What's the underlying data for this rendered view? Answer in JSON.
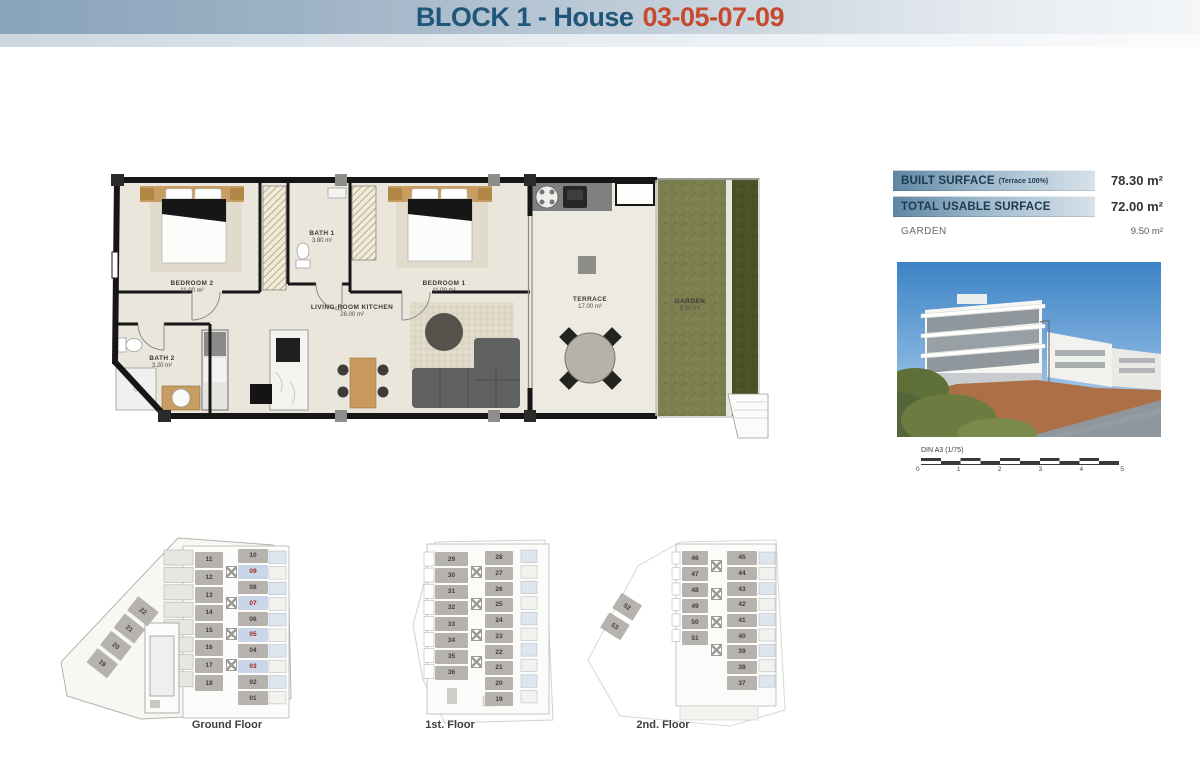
{
  "header": {
    "title_block": "BLOCK 1 - House",
    "title_houses": "03-05-07-09"
  },
  "floor_plan": {
    "rooms": [
      {
        "name": "BEDROOM 2",
        "area": "11.00 m²"
      },
      {
        "name": "BATH 1",
        "area": "3.80 m²"
      },
      {
        "name": "BEDROOM 1",
        "area": "11.00 m²"
      },
      {
        "name": "BATH 2",
        "area": "3.20 m²"
      },
      {
        "name": "LIVING-ROOM KITCHEN",
        "area": "26.00 m²"
      },
      {
        "name": "TERRACE",
        "area": "17.00 m²"
      },
      {
        "name": "GARDEN",
        "area": "9.50 m²"
      }
    ]
  },
  "surface_table": {
    "rows": [
      {
        "label": "BUILT SURFACE",
        "note": "(Terrace 100%)",
        "value": "78.30 m²",
        "highlight": true
      },
      {
        "label": "TOTAL USABLE SURFACE",
        "note": "",
        "value": "72.00 m²",
        "highlight": true
      },
      {
        "label": "GARDEN",
        "note": "",
        "value": "9.50 m²",
        "highlight": false
      }
    ]
  },
  "scale_bar": {
    "label": "DIN A3 (1/75)",
    "ticks": [
      "0",
      "1",
      "2",
      "3",
      "4",
      "5"
    ]
  },
  "mini_plans": {
    "ground": {
      "label": "Ground Floor",
      "mid_units": [
        "11",
        "12",
        "13",
        "14",
        "15",
        "16",
        "17",
        "18"
      ],
      "right_units": [
        {
          "n": "10",
          "hl": false
        },
        {
          "n": "09",
          "hl": true
        },
        {
          "n": "08",
          "hl": false
        },
        {
          "n": "07",
          "hl": true
        },
        {
          "n": "06",
          "hl": false
        },
        {
          "n": "05",
          "hl": true
        },
        {
          "n": "04",
          "hl": false
        },
        {
          "n": "03",
          "hl": true
        },
        {
          "n": "02",
          "hl": false
        },
        {
          "n": "01",
          "hl": false
        }
      ],
      "diag_units": [
        "22",
        "21",
        "20",
        "19"
      ]
    },
    "first": {
      "label": "1st. Floor",
      "left_units": [
        "29",
        "30",
        "31",
        "32",
        "33",
        "34",
        "35",
        "36"
      ],
      "right_units": [
        "28",
        "27",
        "26",
        "25",
        "24",
        "23",
        "22",
        "21",
        "20",
        "19"
      ]
    },
    "second": {
      "label": "2nd. Floor",
      "left_units": [
        "46",
        "47",
        "48",
        "49",
        "50",
        "51"
      ],
      "right_units": [
        "45",
        "44",
        "43",
        "42",
        "41",
        "40",
        "39",
        "38",
        "37"
      ],
      "diag_units": [
        "52",
        "53"
      ]
    }
  },
  "colors": {
    "title_blue": "#1f567a",
    "title_red": "#c64a2e",
    "banner_left": "#88a3bb",
    "table_band_left": "#5e86a4",
    "table_band_right": "#d7e2ea",
    "unit_gray": "#b6b3ae",
    "unit_highlight_bg": "#c9d6ea",
    "unit_highlight_text": "#9c2418",
    "garden_green": "#7c8050",
    "hedge_green": "#4c5226",
    "plan_floor": "#eae6dc"
  }
}
